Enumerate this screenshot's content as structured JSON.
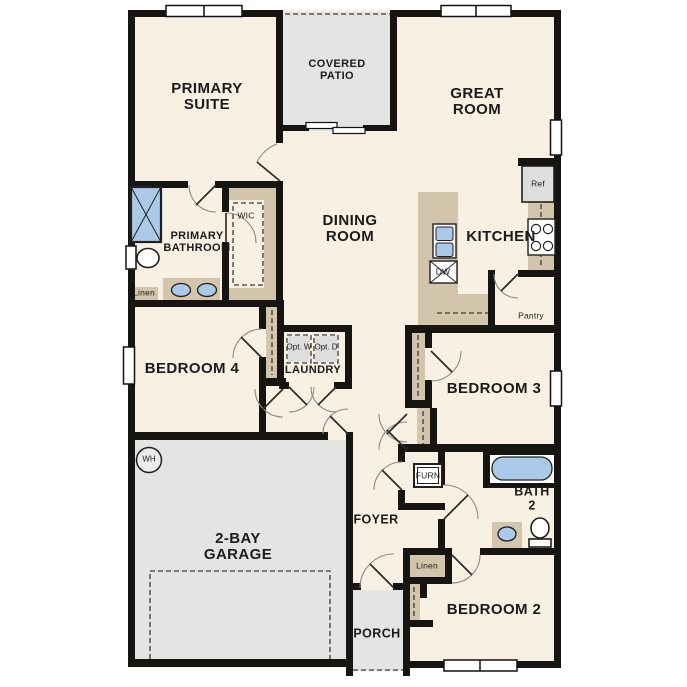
{
  "title": "Single-story floor plan",
  "colors": {
    "floor": "#f7f0e3",
    "outdoor": "#e4e4e2",
    "millwork": "#d2c5ab",
    "wall": "#171512",
    "fixture_blue": "#abcaea",
    "appliance_gray": "#dedede",
    "arc": "#8a8a8a",
    "leaf": "#2b2b2b"
  },
  "rooms": {
    "primary_suite": "PRIMARY SUITE",
    "covered_patio": "COVERED PATIO",
    "great_room": "GREAT ROOM",
    "dining_room": "DINING ROOM",
    "kitchen": "KITCHEN",
    "primary_bathroom": "PRIMARY BATHROOM",
    "wic": "WIC",
    "bedroom4": "BEDROOM 4",
    "laundry": "LAUNDRY",
    "bedroom3": "BEDROOM 3",
    "bath2": "BATH 2",
    "foyer": "FOYER",
    "bedroom2": "BEDROOM 2",
    "garage": "2-BAY GARAGE",
    "porch": "PORCH",
    "pantry": "Pantry"
  },
  "fixtures": {
    "refrigerator": "Ref",
    "dishwasher": "DW",
    "furnace": "FURN",
    "water_heater": "WH",
    "linen_bath": "Linen",
    "linen_hall": "Linen",
    "optional_washer": "Opt. W",
    "optional_dryer": "Opt. D"
  }
}
